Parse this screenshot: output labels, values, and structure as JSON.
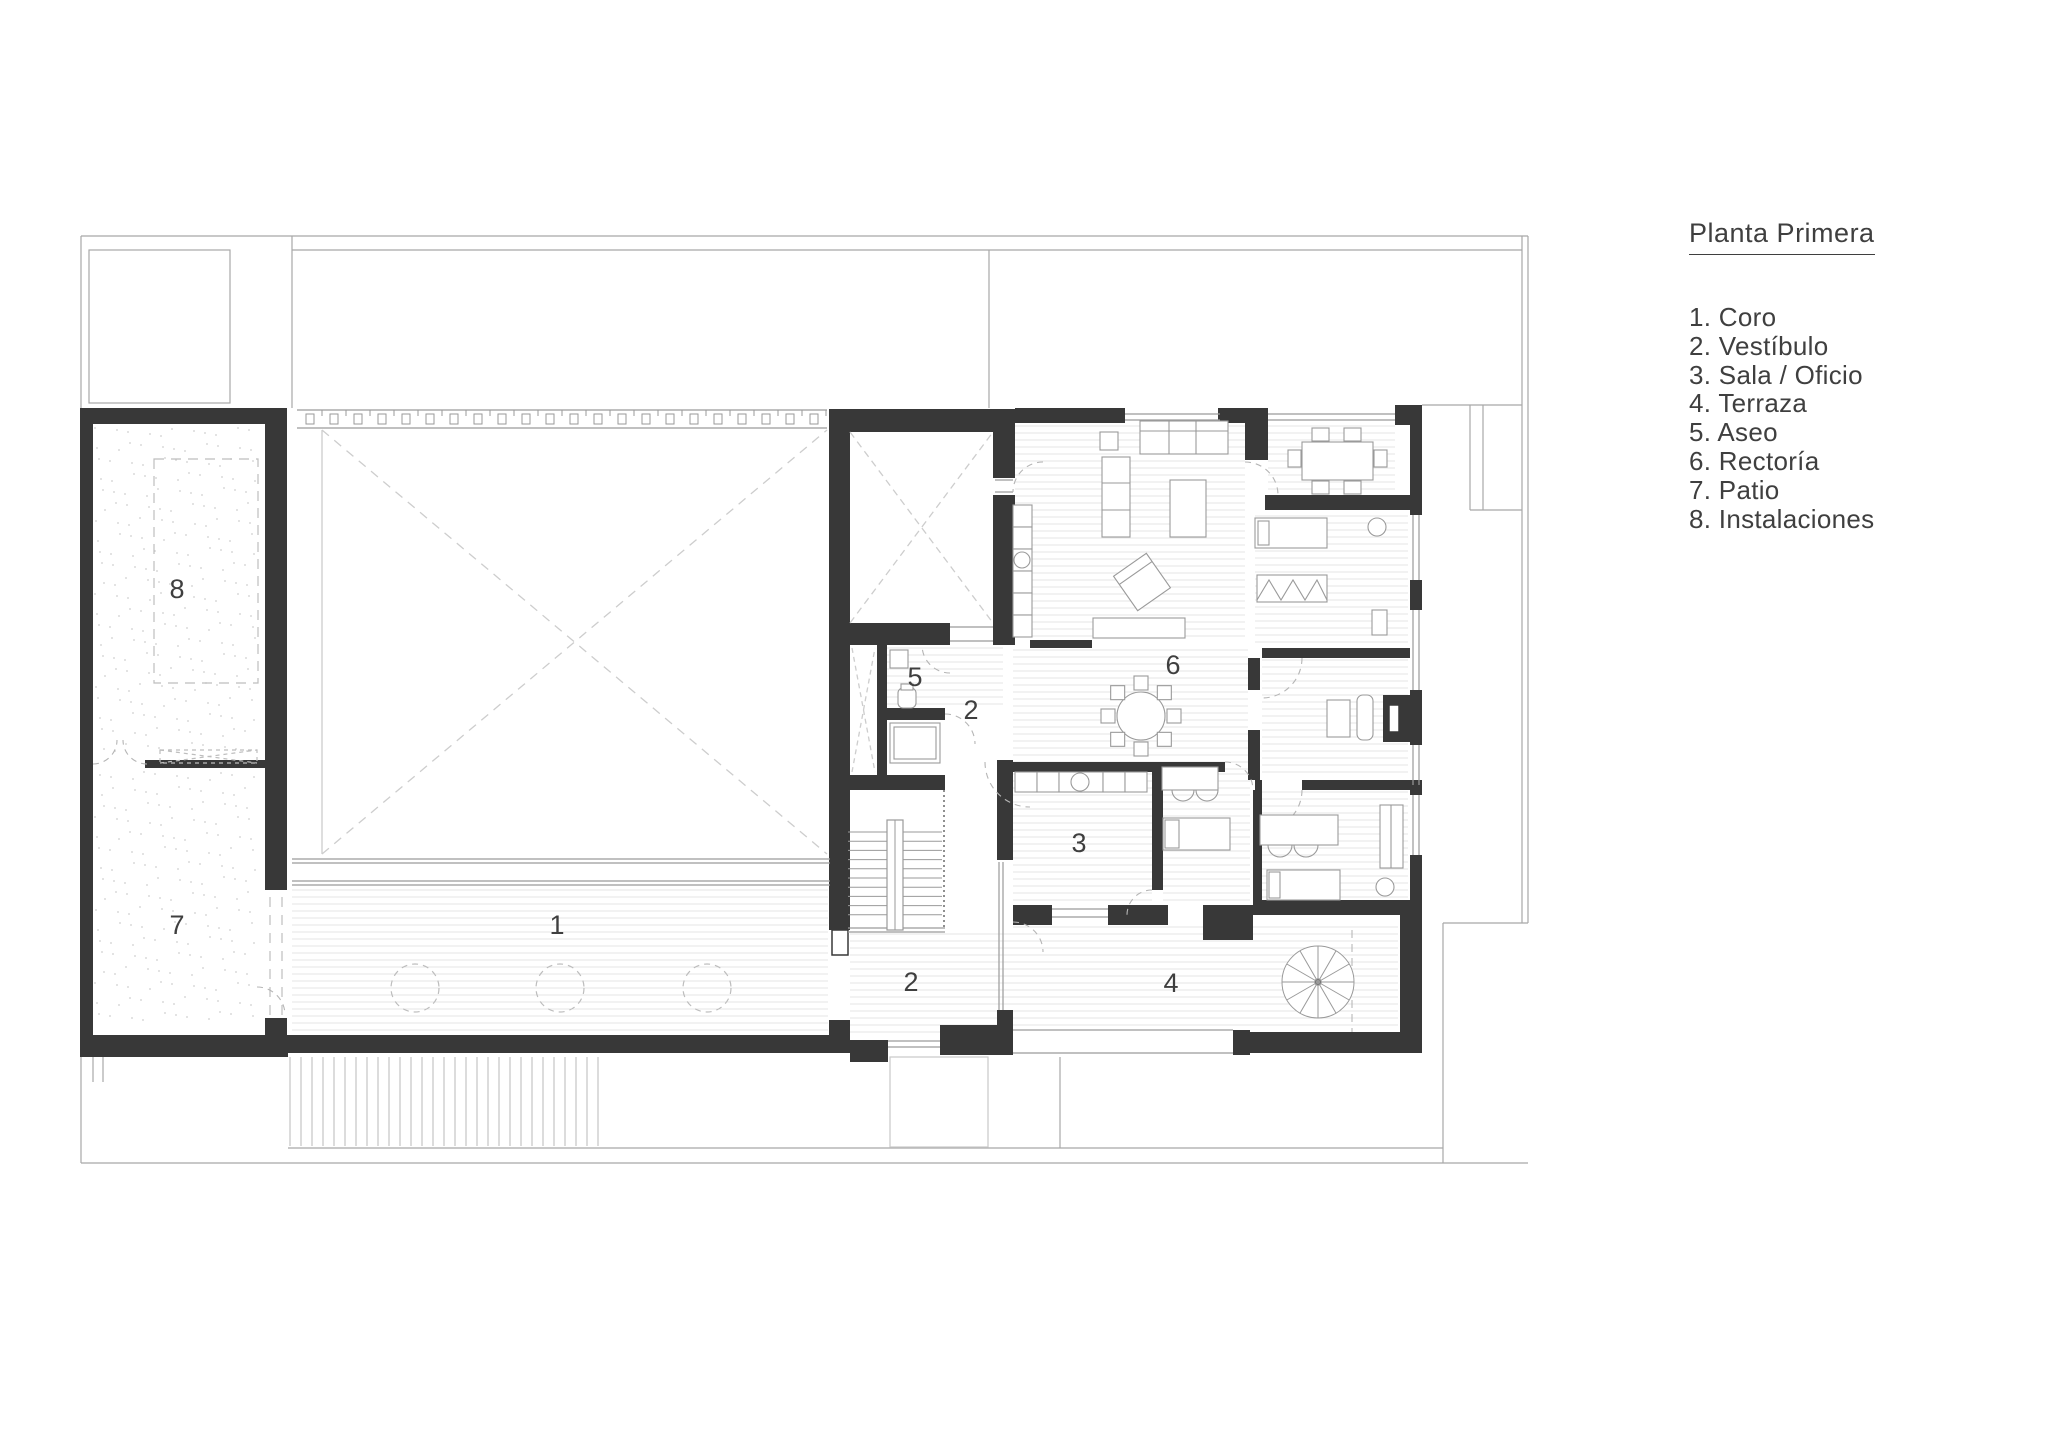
{
  "legend": {
    "title": "Planta Primera",
    "items": [
      {
        "number": "1.",
        "name": "Coro"
      },
      {
        "number": "2.",
        "name": "Vestíbulo"
      },
      {
        "number": "3.",
        "name": "Sala / Oficio"
      },
      {
        "number": "4.",
        "name": "Terraza"
      },
      {
        "number": "5.",
        "name": "Aseo"
      },
      {
        "number": "6.",
        "name": "Rectoría"
      },
      {
        "number": "7.",
        "name": "Patio"
      },
      {
        "number": "8.",
        "name": "Instalaciones"
      }
    ]
  },
  "plan": {
    "room_labels": [
      {
        "id": "coro",
        "label": "1",
        "x": 557,
        "y": 927
      },
      {
        "id": "vestibulo-upper",
        "label": "2",
        "x": 971,
        "y": 712
      },
      {
        "id": "vestibulo-lower",
        "label": "2",
        "x": 911,
        "y": 984
      },
      {
        "id": "sala-oficio",
        "label": "3",
        "x": 1079,
        "y": 845
      },
      {
        "id": "terraza",
        "label": "4",
        "x": 1171,
        "y": 985
      },
      {
        "id": "aseo",
        "label": "5",
        "x": 915,
        "y": 679
      },
      {
        "id": "rectoria",
        "label": "6",
        "x": 1173,
        "y": 667
      },
      {
        "id": "patio",
        "label": "7",
        "x": 177,
        "y": 927
      },
      {
        "id": "instalaciones",
        "label": "8",
        "x": 177,
        "y": 591
      }
    ],
    "colors": {
      "wall": "#383838",
      "line": "#9a9a9a",
      "light_line": "#c9c9c9",
      "hatch": "#e6e6e6",
      "dash": "#bdbdbd",
      "text": "#3f3f3f",
      "background": "#ffffff"
    }
  }
}
